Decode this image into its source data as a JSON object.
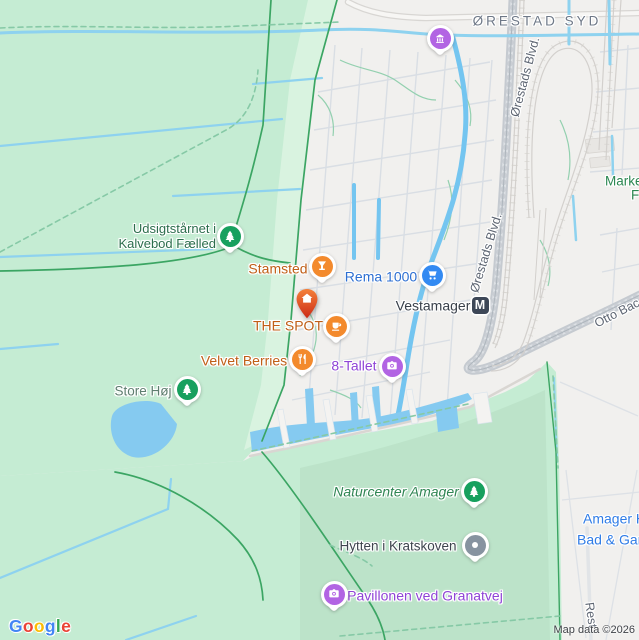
{
  "colors": {
    "park_green": "#c5ecd3",
    "park_green_light": "#d9f3e0",
    "forest_green": "#bce3c9",
    "urban": "#f1f0ee",
    "water": "#85caf0",
    "ditch_blue": "#8ed2ef",
    "trail_green": "#3ba563",
    "road_gray": "#c5cad0",
    "poi_orange": "#f38a2d",
    "poi_blue": "#338af2",
    "poi_purple": "#b264e3",
    "poi_green": "#17a05e",
    "poi_gray": "#8793a0",
    "metro_navy": "#3d4757",
    "spot_pin_top": "#f4813a",
    "spot_pin_bottom": "#cc2a16"
  },
  "district_label": "ØRESTAD SYD",
  "road_labels": {
    "orestads_blvd": "Ørestads Blvd.",
    "otto_bache": "Otto Bac",
    "rest": "Rest"
  },
  "pois": [
    {
      "id": "udsigtstaarnet-i-kalvebod-faelled",
      "line1": "Udsigtstårnet i",
      "line2": "Kalvebod Fælled",
      "icon": "tree",
      "pin_color": "#17a05e",
      "label_color": "#2c6e4d"
    },
    {
      "id": "stamsted",
      "label": "Stamsted",
      "icon": "cocktail",
      "pin_color": "#f38a2d",
      "label_color": "#c05f17"
    },
    {
      "id": "rema-1000",
      "label": "Rema 1000",
      "icon": "shopping-cart",
      "pin_color": "#338af2",
      "label_color": "#2d6fd2"
    },
    {
      "id": "the-spot",
      "label": "THE SPOT",
      "icon": "house",
      "pin_color": "#e05426",
      "label_color": "#c05f17"
    },
    {
      "id": "cafe-pin",
      "label": "",
      "icon": "coffee-cup",
      "pin_color": "#f38a2d"
    },
    {
      "id": "vestamager-station",
      "label": "Vestamager",
      "badge": "M",
      "badge_color": "#3d4757",
      "label_color": "#39404a"
    },
    {
      "id": "velvet-berries",
      "label": "Velvet Berries",
      "icon": "restaurant",
      "pin_color": "#f38a2d",
      "label_color": "#c05f17"
    },
    {
      "id": "8-tallet",
      "label": "8-Tallet",
      "icon": "camera",
      "pin_color": "#b264e3",
      "label_color": "#8f44d6"
    },
    {
      "id": "museum-pin",
      "label": "",
      "icon": "museum",
      "pin_color": "#b264e3"
    },
    {
      "id": "store-hoej",
      "label": "Store Høj",
      "icon": "tree",
      "pin_color": "#17a05e",
      "label_color": "#5e7e6f"
    },
    {
      "id": "naturcenter-amager",
      "label": "Naturcenter Amager",
      "icon": "tree",
      "pin_color": "#17a05e",
      "label_color": "#2f8553"
    },
    {
      "id": "hytten-i-kratskoven",
      "label": "Hytten i Kratskoven",
      "icon": "dot",
      "pin_color": "#8793a0",
      "label_color": "#3e454e"
    },
    {
      "id": "pavillonen-ved-granatvej",
      "label": "Pavillonen ved Granatvej",
      "icon": "camera",
      "pin_color": "#b264e3",
      "label_color": "#8f44d6"
    },
    {
      "id": "amager-truncated",
      "line1": "Amager H",
      "line2": "Bad & Gar",
      "label_color": "#2f7ce6"
    },
    {
      "id": "marked-truncated",
      "line1": "Marke",
      "line2": "F",
      "label_color": "#2b8751"
    }
  ],
  "footer": {
    "attribution": "Map data ©2026",
    "logo": [
      {
        "ch": "G",
        "color": "#4285F4"
      },
      {
        "ch": "o",
        "color": "#EA4335"
      },
      {
        "ch": "o",
        "color": "#FBBC05"
      },
      {
        "ch": "g",
        "color": "#4285F4"
      },
      {
        "ch": "l",
        "color": "#34A853"
      },
      {
        "ch": "e",
        "color": "#EA4335"
      }
    ]
  }
}
